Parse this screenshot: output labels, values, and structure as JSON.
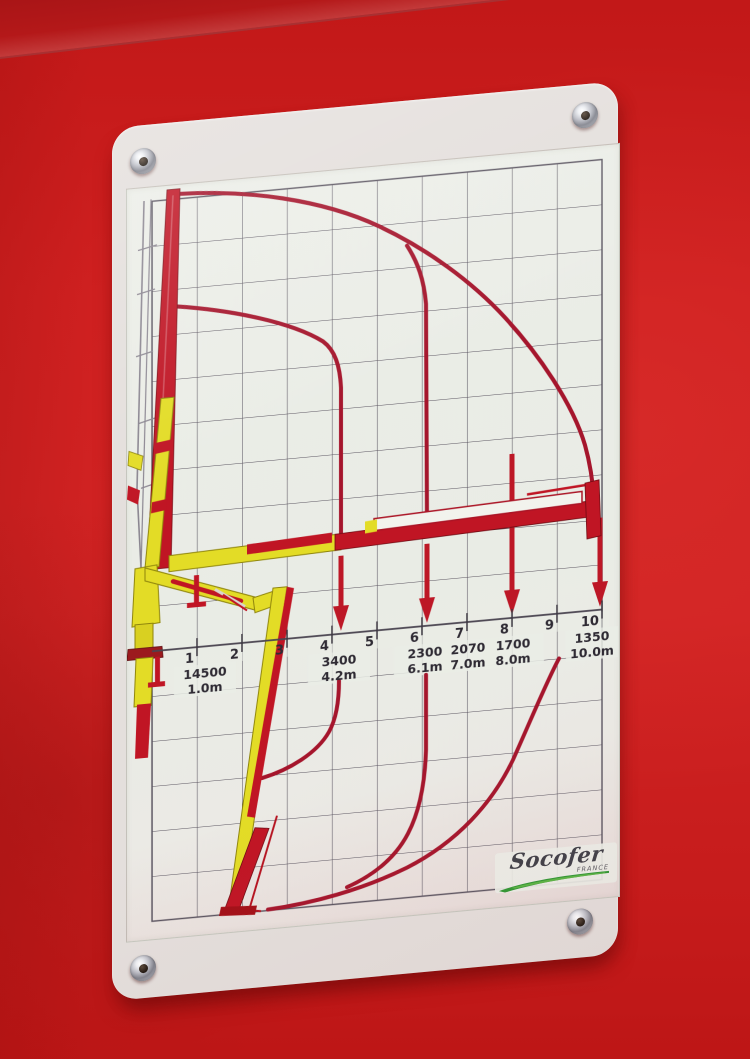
{
  "scene": {
    "surface_color": "#cf1e1e",
    "plate_color": "#e4dfdc",
    "sticker_color": "#eaede6",
    "screw_count": 4
  },
  "brand": {
    "name": "Socofer",
    "country": "FRANCE"
  },
  "chart_data": {
    "type": "line",
    "title": "Crane load chart: lifting capacity (kg) vs outreach (m), envelope above and below ground level",
    "x_unit": "m",
    "x_range": [
      0,
      10
    ],
    "x_ticks": [
      "1",
      "2",
      "3",
      "4",
      "5",
      "6",
      "7",
      "8",
      "9",
      "10"
    ],
    "grid": {
      "cols": 10,
      "rows": 16,
      "ground_row": 10,
      "cell_m": 1,
      "on": true
    },
    "colors": {
      "curve": "#a5152c",
      "crane_red": "#c01524",
      "crane_yellow": "#e3dc26",
      "grid_line": "#5a5460",
      "text": "#2e2a33",
      "logo_green": "#2f9733"
    },
    "load_points": [
      {
        "capacity": "14500",
        "capacity_kg": 14500,
        "reach": "1.0m",
        "reach_m": 1.0
      },
      {
        "capacity": "3400",
        "capacity_kg": 3400,
        "reach": "4.2m",
        "reach_m": 4.2
      },
      {
        "capacity": "2300",
        "capacity_kg": 2300,
        "reach": "6.1m",
        "reach_m": 6.1
      },
      {
        "capacity": "2070",
        "capacity_kg": 2070,
        "reach": "7.0m",
        "reach_m": 7.0
      },
      {
        "capacity": "1700",
        "capacity_kg": 1700,
        "reach": "8.0m",
        "reach_m": 8.0
      },
      {
        "capacity": "1350",
        "capacity_kg": 1350,
        "reach": "10.0m",
        "reach_m": 10.0
      }
    ],
    "series": [
      {
        "name": "reach envelope above ground (to 10 m)"
      },
      {
        "name": "envelope drop line at 6.1 m"
      },
      {
        "name": "envelope drop line at 4.2 m"
      },
      {
        "name": "below-ground envelope to 4.2 m"
      },
      {
        "name": "below-ground envelope to 6.1 m"
      },
      {
        "name": "below-ground outer envelope"
      }
    ]
  }
}
